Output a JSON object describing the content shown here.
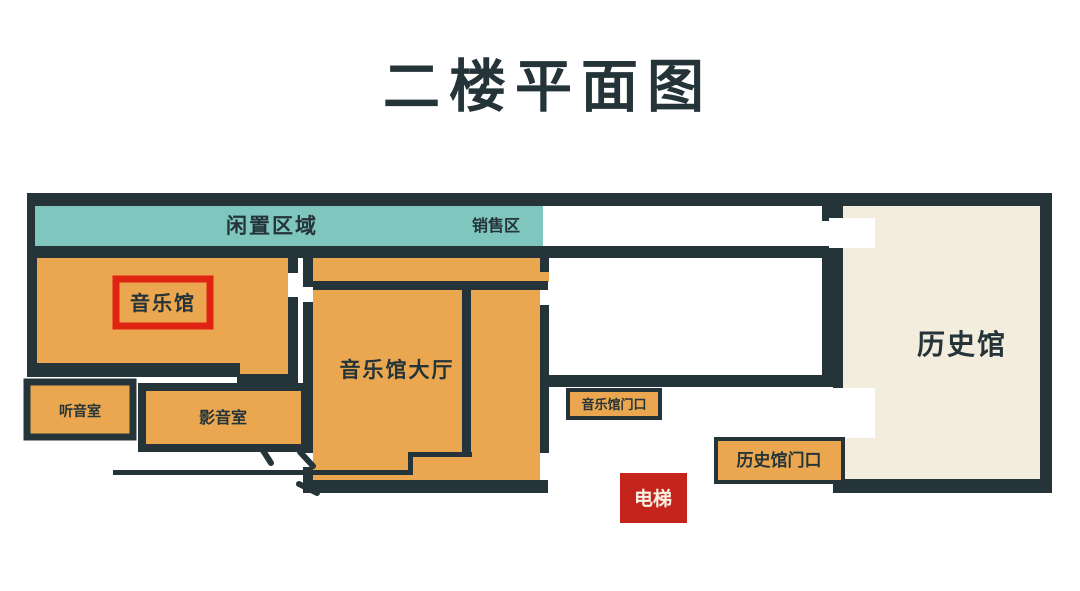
{
  "floor_plan": {
    "title": "二楼平面图",
    "rooms": {
      "idle_zone": "闲置区域",
      "sales_zone": "销售区",
      "music_hall": "音乐馆",
      "music_hall_lobby": "音乐馆大厅",
      "listening_room": "听音室",
      "av_room": "影音室",
      "music_hall_entrance": "音乐馆门口",
      "history_hall_entrance": "历史馆门口",
      "elevator": "电梯",
      "history_hall": "历史馆"
    }
  },
  "colors": {
    "wall": "#243439",
    "orange": "#EBA750",
    "teal": "#7FC6BE",
    "cream": "#F3EDDD",
    "red": "#C5241C",
    "highlight": "#E02313",
    "light-text": "#F8F2E2",
    "paper": "#FFFFFF"
  }
}
